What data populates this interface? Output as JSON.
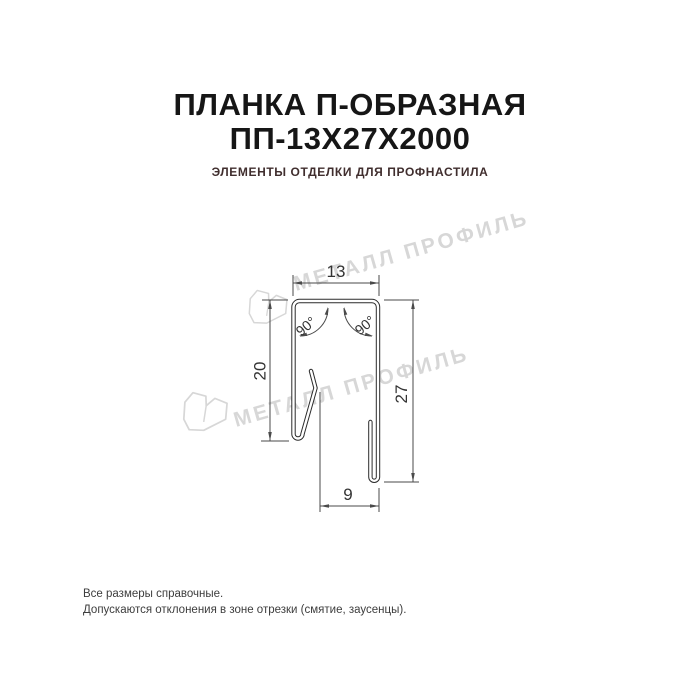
{
  "header": {
    "title_line1": "ПЛАНКА П-ОБРАЗНАЯ",
    "title_line2": "ПП-13Х27Х2000",
    "subtitle": "ЭЛЕМЕНТЫ ОТДЕЛКИ ДЛЯ ПРОФНАСТИЛА"
  },
  "drawing": {
    "type": "technical cross-section of U-shaped strip",
    "dimensions": {
      "top_width": "13",
      "left_height": "20",
      "right_height": "27",
      "bottom_width": "9",
      "angle_left": "90°",
      "angle_right": "90°"
    }
  },
  "watermark": {
    "text": "МЕТАЛЛ ПРОФИЛЬ"
  },
  "footer": {
    "line1": "Все размеры справочные.",
    "line2": "Допускаются отклонения в зоне отрезки (смятие, заусенцы)."
  },
  "colors": {
    "title": "#161616",
    "subtitle": "#402e2e",
    "drawing_line": "#2b2b2b",
    "dimension_line": "#4a4a4a",
    "watermark": "#d7d7d7",
    "background": "#ffffff"
  }
}
